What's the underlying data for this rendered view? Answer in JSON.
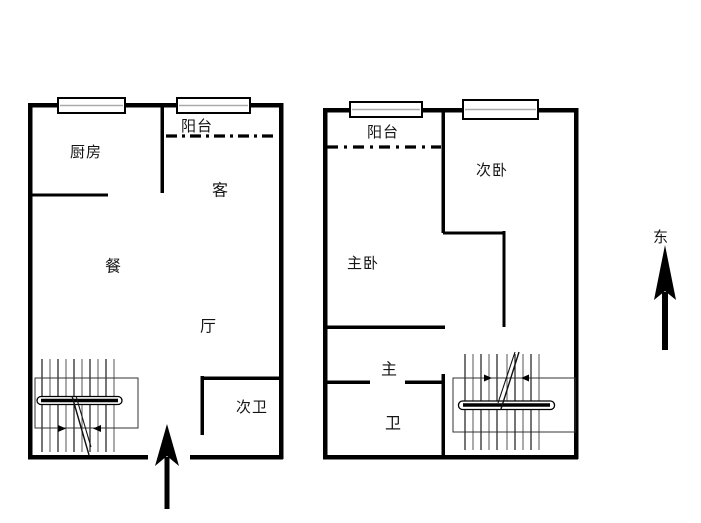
{
  "page": {
    "background": "#ffffff",
    "line_color": "#000000"
  },
  "plan": {
    "left_unit": {
      "kitchen": "厨房",
      "balcony": "阳台",
      "living": "客",
      "dining": "餐",
      "hall": "厅",
      "secondary_bath": "次卫"
    },
    "right_unit": {
      "balcony": "阳台",
      "secondary_bedroom": "次卧",
      "master_bedroom": "主卧",
      "master_char": "主",
      "bath_char": "卫"
    },
    "compass": {
      "east": "东"
    }
  }
}
